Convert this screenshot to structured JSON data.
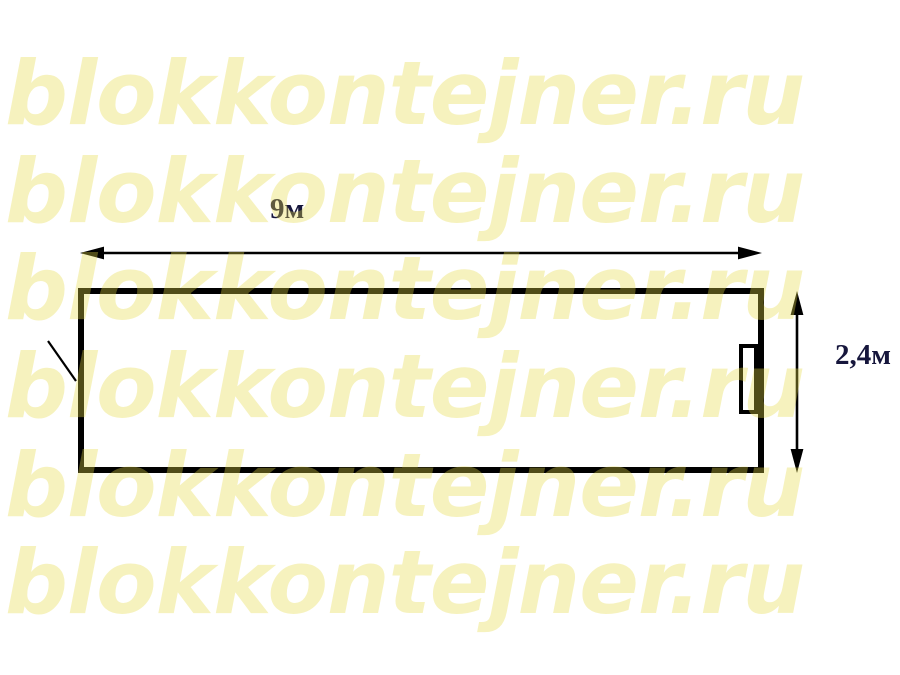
{
  "watermark": {
    "text": "blokkontejner.ru",
    "color": "#E5D945",
    "opacity": 0.35,
    "rows": 6
  },
  "diagram": {
    "type": "dimension-drawing",
    "subject": "block container plan",
    "width_label": "9м",
    "height_label": "2,4м",
    "width_value_m": 9,
    "height_value_m": 2.4,
    "line_color": "#000000",
    "label_color": "#16163C",
    "background_color": "#FFFFFF"
  }
}
